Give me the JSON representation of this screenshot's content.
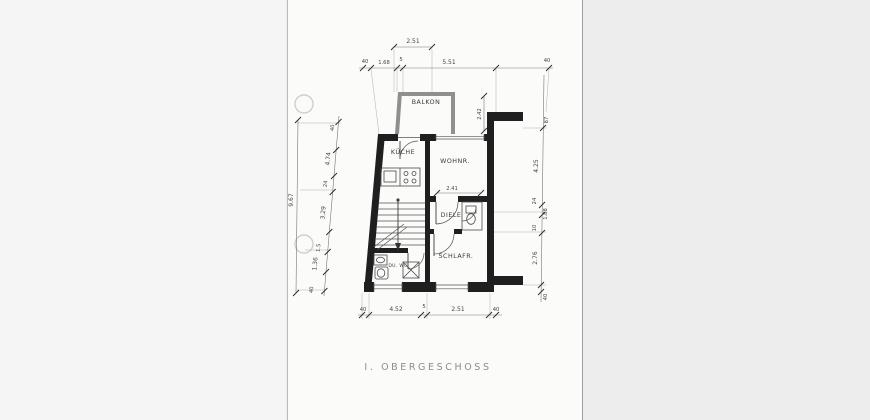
{
  "sheet": {
    "caption": "I. OBERGESCHOSS",
    "rooms": {
      "balkon": "BALKON",
      "kueche": "KÜCHE",
      "wohnraum": "WOHNR.",
      "diele": "DIELE",
      "schlafraum": "SCHLAFR.",
      "bad": "DU. WC"
    },
    "dimensions": {
      "top_overall": "2.51",
      "top": [
        "40",
        "1.68",
        "5",
        "5.51",
        "40"
      ],
      "bottom": [
        "40",
        "4.52",
        "5",
        "2.51",
        "40"
      ],
      "right": [
        "87",
        "4.25",
        "24",
        "1.88",
        "10",
        "2.76",
        "40"
      ],
      "left": [
        "40",
        "4.74",
        "24",
        "3.29",
        "1.5",
        "1.36",
        "40"
      ],
      "left_overall": "9.67",
      "balcony_depth": "2.42",
      "room_width": "2.41"
    },
    "colors": {
      "ink": "#1f1f1f",
      "masonry_wall": "#8f8f8f",
      "dim_ink": "#4a4a4a",
      "caption_ink": "#8d8d8d",
      "paper": "#fbfbfa",
      "backdrop": "#ededed"
    }
  }
}
